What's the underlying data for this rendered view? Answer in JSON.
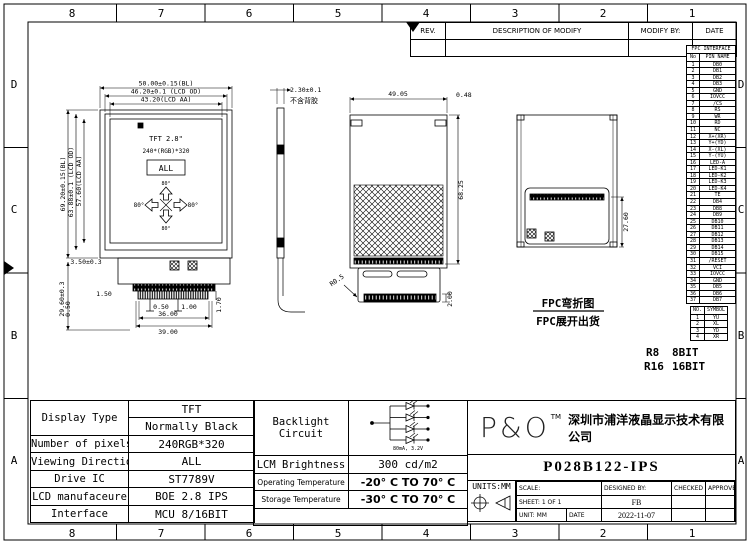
{
  "frame": {
    "cols": [
      "8",
      "7",
      "6",
      "5",
      "4",
      "3",
      "2",
      "1"
    ],
    "rows": [
      "D",
      "C",
      "B",
      "A"
    ]
  },
  "revision_table": {
    "headers": [
      "REV.",
      "DESCRIPTION OF MODIFY",
      "MODIFY BY:",
      "DATE"
    ]
  },
  "fpc_interface": {
    "title": "FPC INTERFACE",
    "col_no": "No",
    "col_name": "PIN NAME",
    "pins": [
      {
        "no": "1",
        "name": "DB0"
      },
      {
        "no": "2",
        "name": "DB1"
      },
      {
        "no": "3",
        "name": "DB2"
      },
      {
        "no": "4",
        "name": "DB3"
      },
      {
        "no": "5",
        "name": "GND"
      },
      {
        "no": "6",
        "name": "IOVCC"
      },
      {
        "no": "7",
        "name": "/CS"
      },
      {
        "no": "8",
        "name": "RS"
      },
      {
        "no": "9",
        "name": "WR"
      },
      {
        "no": "10",
        "name": "RD"
      },
      {
        "no": "11",
        "name": "NC"
      },
      {
        "no": "12",
        "name": "X+(XR)"
      },
      {
        "no": "13",
        "name": "Y+(YD)"
      },
      {
        "no": "14",
        "name": "X-(XL)"
      },
      {
        "no": "15",
        "name": "Y-(YU)"
      },
      {
        "no": "16",
        "name": "LED-A"
      },
      {
        "no": "17",
        "name": "LED-K1"
      },
      {
        "no": "18",
        "name": "LED-K2"
      },
      {
        "no": "19",
        "name": "LED-K3"
      },
      {
        "no": "20",
        "name": "LED-K4"
      },
      {
        "no": "21",
        "name": "TE"
      },
      {
        "no": "22",
        "name": "DB4"
      },
      {
        "no": "23",
        "name": "DB8"
      },
      {
        "no": "24",
        "name": "DB9"
      },
      {
        "no": "25",
        "name": "DB10"
      },
      {
        "no": "26",
        "name": "DB11"
      },
      {
        "no": "27",
        "name": "DB12"
      },
      {
        "no": "28",
        "name": "DB13"
      },
      {
        "no": "29",
        "name": "DB14"
      },
      {
        "no": "30",
        "name": "DB15"
      },
      {
        "no": "31",
        "name": "/RESET"
      },
      {
        "no": "32",
        "name": "VCI"
      },
      {
        "no": "33",
        "name": "IOVCC"
      },
      {
        "no": "34",
        "name": "GND"
      },
      {
        "no": "35",
        "name": "DB5"
      },
      {
        "no": "36",
        "name": "DB6"
      },
      {
        "no": "37",
        "name": "DB7"
      }
    ]
  },
  "touch_table": {
    "col_no": "NO.",
    "col_symbol": "SYMBOL",
    "rows": [
      {
        "no": "1",
        "symbol": "YU"
      },
      {
        "no": "2",
        "symbol": "XL"
      },
      {
        "no": "3",
        "symbol": "YD"
      },
      {
        "no": "4",
        "symbol": "XR"
      }
    ]
  },
  "bit_note": {
    "r8": "R8",
    "r8_val": "8BIT",
    "r16": "R16",
    "r16_val": "16BIT"
  },
  "views": {
    "front": {
      "title": "TFT 2.8\"",
      "pixels": "240*(RGB)*320",
      "all": "ALL",
      "angle_top": "80°",
      "angle_left": "80°",
      "angle_right": "80°",
      "angle_bottom": "80°",
      "dims": {
        "w_bl": "50.00±0.15(BL)",
        "w_od": "46.20±0.1 (LCD OD)",
        "w_aa": "43.20(LCD AA)",
        "h_bl": "69.20±0.15(BL)",
        "h_od": "63.88±0.1 (LCD OD)",
        "h_aa": "57.60(LCD AA)",
        "step": "3.50±0.3",
        "fpc_len": "29.60±0.3",
        "offset": "1.50",
        "edge": "0.50",
        "pitch": "0.50",
        "pin_w": "1.00",
        "conn_w": "36.00",
        "fpc_w": "39.00",
        "tail": "1.70"
      }
    },
    "side": {
      "thickness": "2.30±0.1",
      "note": "不含背胶"
    },
    "unfolded": {
      "dims": {
        "w": "49.05",
        "corner": "0.48",
        "h": "68.25",
        "radius": "R0.5",
        "tail": "2.00"
      }
    },
    "folded": {
      "dims": {
        "h": "27.60"
      },
      "caption1": "FPC弯折图",
      "caption2": "FPC展开出货"
    }
  },
  "spec": {
    "display_type_label": "Display Type",
    "display_type_1": "TFT",
    "display_type_2": "Normally Black",
    "pixels_label": "Number of pixels",
    "pixels": "240RGB*320",
    "viewing_label": "Viewing Direction",
    "viewing": "ALL",
    "drive_label": "Drive IC",
    "drive": "ST7789V",
    "manufacturer_label": "LCD manufaceure",
    "manufacturer": "BOE 2.8 IPS",
    "interface_label": "Interface",
    "interface": "MCU 8/16BIT",
    "backlight_label_1": "Backlight",
    "backlight_label_2": "Circuit",
    "backlight_rating": "80mA, 3.2V",
    "brightness_label": "LCM Brightness",
    "brightness": "300 cd/m2",
    "op_temp_label": "Operating Temperature",
    "op_temp": "-20° C TO 70° C",
    "st_temp_label": "Storage Temperature",
    "st_temp": "-30° C TO 70° C"
  },
  "title_block": {
    "logo": "P&O",
    "tm": "TM",
    "company": "深圳市浦洋液晶显示技术有限公司",
    "part_number": "P028B122-IPS",
    "units": "UNITS:MM",
    "scale_label": "SCALE:",
    "designed_label": "DESIGNED BY:",
    "checked_label": "CHECKED BY:",
    "approved_label": "APPROVED BY:",
    "sheet_label": "SHEET: 1 OF 1",
    "designer": "FB",
    "unit_label": "UNIT: MM",
    "date_label": "DATE",
    "date": "2022-11-07"
  }
}
